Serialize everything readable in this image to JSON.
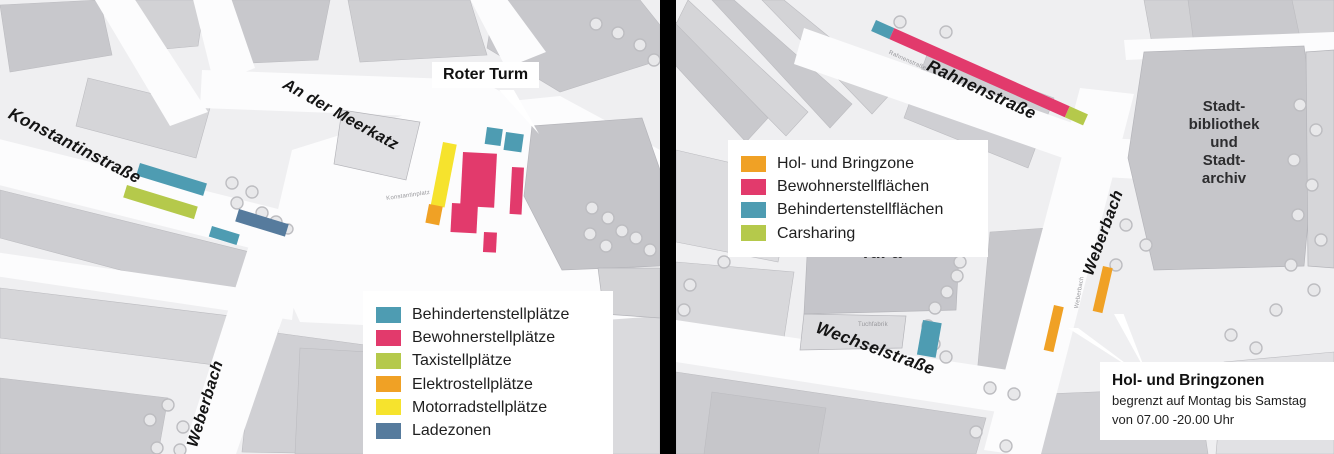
{
  "colors": {
    "behinderten": "#4E9CB2",
    "bewohner": "#E23A6C",
    "taxi": "#B5C94B",
    "elektro": "#F0A125",
    "motorrad": "#F6E32D",
    "ladezone": "#567B9D",
    "carsharing": "#B5C94B",
    "hol_bring": "#F0A125"
  },
  "left_map": {
    "street_labels": {
      "konstantinstrasse": "Konstantinstraße",
      "an_der_meerkatz": "An der Meerkatz",
      "weberbach": "Weberbach"
    },
    "minor_labels": {
      "konstantinplatz": "Konstantinplatz"
    },
    "callout_label": "Roter Turm",
    "legend": {
      "items": [
        {
          "label": "Behindertenstellplätze",
          "color": "#4E9CB2"
        },
        {
          "label": "Bewohnerstellplätze",
          "color": "#E23A6C"
        },
        {
          "label": "Taxistellplätze",
          "color": "#B5C94B"
        },
        {
          "label": "Elektrostellplätze",
          "color": "#F0A125"
        },
        {
          "label": "Motorradstellplätze",
          "color": "#F6E32D"
        },
        {
          "label": "Ladezonen",
          "color": "#567B9D"
        }
      ]
    }
  },
  "right_map": {
    "street_labels": {
      "rahnenstrasse": "Rahnenstraße",
      "weberbach": "Weberbach",
      "wechselstrasse": "Wechselstraße"
    },
    "minor_labels": {
      "rahnenstrasse_small": "Rahnenstraße",
      "weberbach_small": "Weberbach",
      "tuchfabrik": "Tuchfabrik"
    },
    "building_labels": {
      "tufa": "TuFa",
      "stadtbibliothek_lines": [
        "Stadt-",
        "bibliothek",
        "und",
        "Stadt-",
        "archiv"
      ]
    },
    "legend": {
      "items": [
        {
          "label": "Hol- und Bringzone",
          "color": "#F0A125"
        },
        {
          "label": "Bewohnerstellflächen",
          "color": "#E23A6C"
        },
        {
          "label": "Behindertenstellflächen",
          "color": "#4E9CB2"
        },
        {
          "label": "Carsharing",
          "color": "#B5C94B"
        }
      ]
    },
    "callout": {
      "title": "Hol- und Bringzonen",
      "line1": "begrenzt auf Montag bis Samstag",
      "line2": "von 07.00 -20.00 Uhr"
    }
  }
}
